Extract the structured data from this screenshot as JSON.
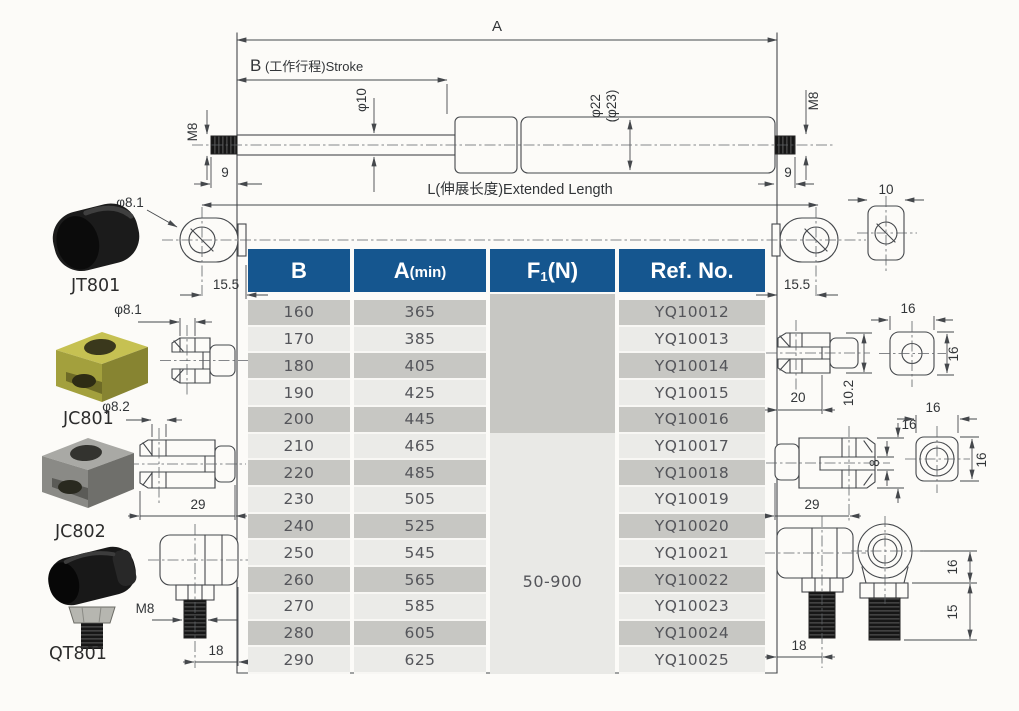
{
  "drawing": {
    "dim_a": "A",
    "dim_b_letter": "B",
    "dim_b_rest": " (工作行程)Stroke",
    "dim_l": "L(伸展长度)Extended Length",
    "rod_dia": "φ10",
    "tube_dia": "φ22",
    "tube_dia_alt": "(φ23)",
    "thread_left": "M8",
    "thread_left_len": "9",
    "thread_right": "M8",
    "thread_right_len": "9"
  },
  "left_panel": {
    "eyelet_hole_dia": "φ8.1",
    "eyelet_width": "15.5",
    "fittings": [
      {
        "code": "JT801"
      },
      {
        "code": "JC801",
        "hole_dia": "φ8.1"
      },
      {
        "code": "JC802",
        "hole_dia": "φ8.2",
        "length": "29"
      },
      {
        "code": "QT801",
        "thread": "M8",
        "length": "18"
      }
    ]
  },
  "right_panel": {
    "eyelet_width": "15.5",
    "eyelet_thickness": "10",
    "clevis1": {
      "depth": "20",
      "height": "10.2",
      "front_width": "16",
      "front_height": "16"
    },
    "clevis2": {
      "length": "29",
      "slot_width": "8",
      "fork_height": "16",
      "front_width": "16",
      "front_height": "16"
    },
    "ball_joint": {
      "length": "18",
      "center_height": "16",
      "thread_length": "15"
    }
  },
  "table": {
    "headers": [
      {
        "label": "B"
      },
      {
        "label": "A",
        "suffix": "(min)"
      },
      {
        "label": "F",
        "sub": "1",
        "suffix": "(N)"
      },
      {
        "label": "Ref. No."
      }
    ],
    "f1_value": "50-900",
    "rows": [
      {
        "b": "160",
        "a_min": "365",
        "ref": "YQ10012"
      },
      {
        "b": "170",
        "a_min": "385",
        "ref": "YQ10013"
      },
      {
        "b": "180",
        "a_min": "405",
        "ref": "YQ10014"
      },
      {
        "b": "190",
        "a_min": "425",
        "ref": "YQ10015"
      },
      {
        "b": "200",
        "a_min": "445",
        "ref": "YQ10016"
      },
      {
        "b": "210",
        "a_min": "465",
        "ref": "YQ10017"
      },
      {
        "b": "220",
        "a_min": "485",
        "ref": "YQ10018"
      },
      {
        "b": "230",
        "a_min": "505",
        "ref": "YQ10019"
      },
      {
        "b": "240",
        "a_min": "525",
        "ref": "YQ10020"
      },
      {
        "b": "250",
        "a_min": "545",
        "ref": "YQ10021"
      },
      {
        "b": "260",
        "a_min": "565",
        "ref": "YQ10022"
      },
      {
        "b": "270",
        "a_min": "585",
        "ref": "YQ10023"
      },
      {
        "b": "280",
        "a_min": "605",
        "ref": "YQ10024"
      },
      {
        "b": "290",
        "a_min": "625",
        "ref": "YQ10025"
      }
    ]
  },
  "colors": {
    "header_bg": "#15568f",
    "row_gray": "#c7c7c3",
    "row_light": "#ebebe8",
    "line": "#45484c"
  }
}
